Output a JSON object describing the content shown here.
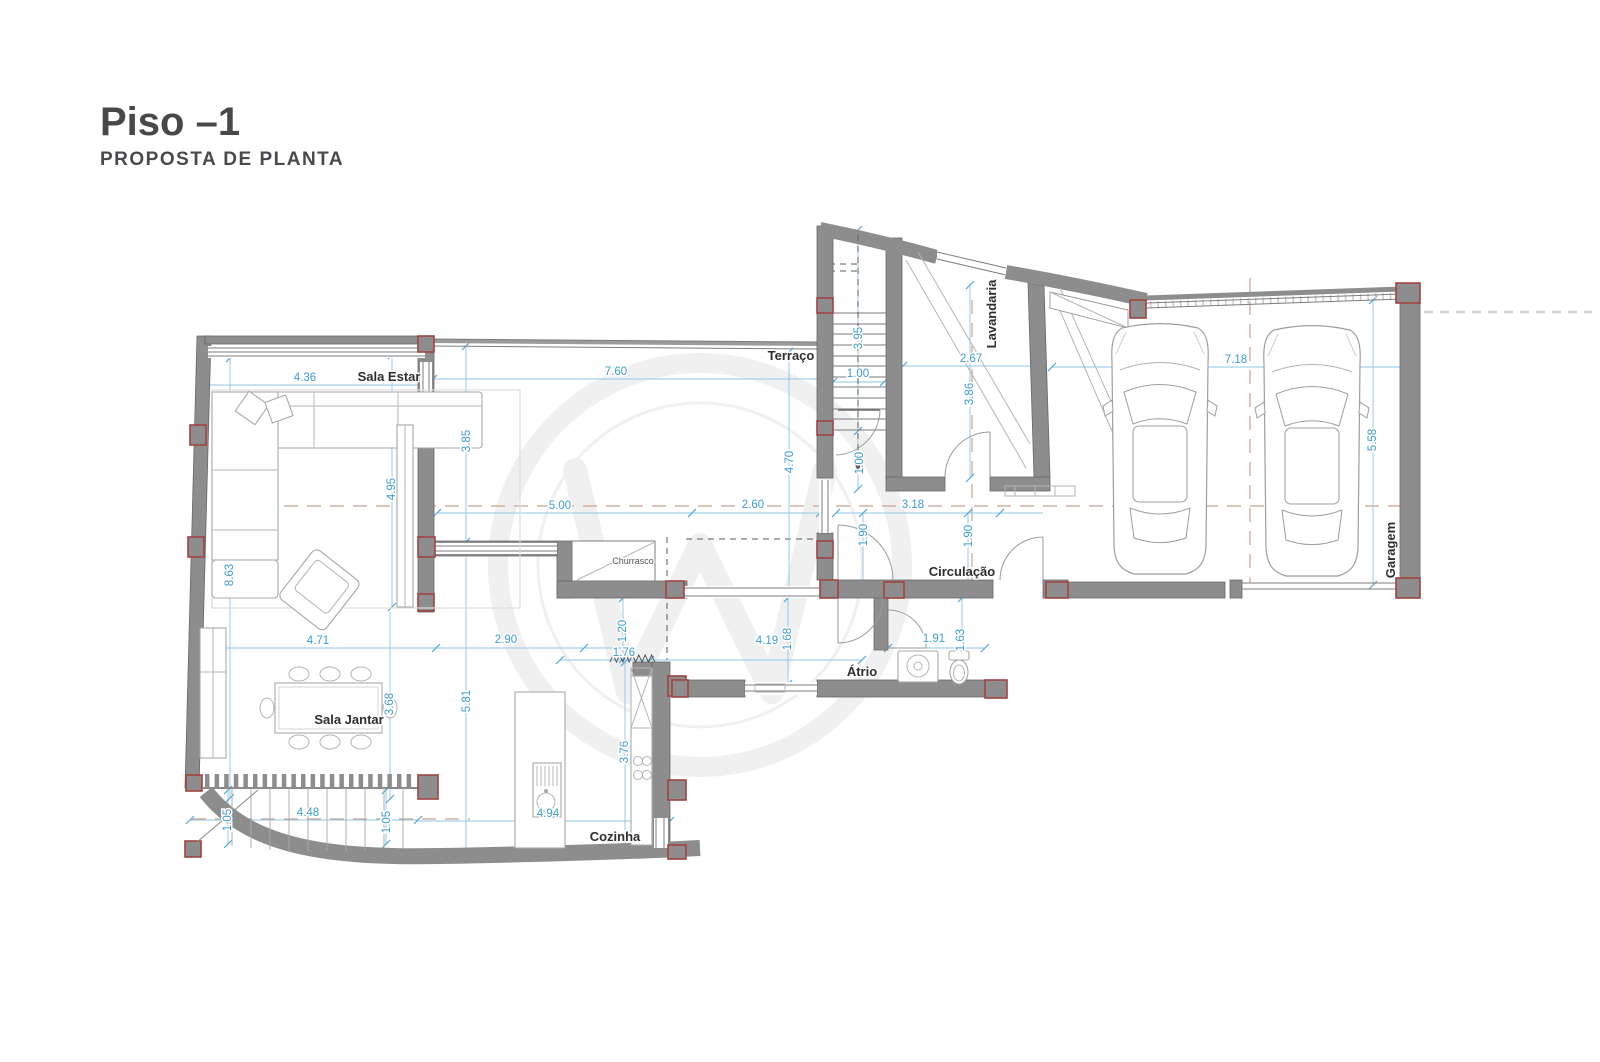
{
  "title": "Piso –1",
  "subtitle": "PROPOSTA DE PLANTA",
  "rooms": {
    "sala_estar": "Sala Estar",
    "terraco": "Terraço",
    "lavandaria": "Lavandaria",
    "garagem": "Garagem",
    "circulacao": "Circulação",
    "atrio": "Átrio",
    "sala_jantar": "Sala Jantar",
    "cozinha": "Cozinha",
    "churrasco": "Churrasco"
  },
  "dims": {
    "a1": "4.36",
    "a2": "7.60",
    "a3": "1.00",
    "a4": "2.67",
    "a5": "7.18",
    "a6": "5.00",
    "a7": "2.60",
    "a8": "3.18",
    "a9": "4.71",
    "a10": "2.90",
    "a11": "1.76",
    "a12": "4.19",
    "a13": "1.91",
    "a14": "4.48",
    "a15": "4.94",
    "v1": "3.85",
    "v2": "4.95",
    "v3": "8.63",
    "v4": "4.70",
    "v5": "3.95",
    "v6": "1.00",
    "v7": "3.86",
    "v8": "1.90",
    "v9": "1.90",
    "v10": "5.58",
    "v11": "3.68",
    "v12": "5.81",
    "v13": "1.20",
    "v14": "1.68",
    "v15": "1.63",
    "v16": "3.76",
    "v17": "1.05",
    "v18": "1.05"
  },
  "colors": {
    "wall": "#8d8d8d",
    "column_outline": "#a04341",
    "dimension_text": "#3f9bd0",
    "centerline": "#c9a291",
    "title_text": "#48484b"
  }
}
